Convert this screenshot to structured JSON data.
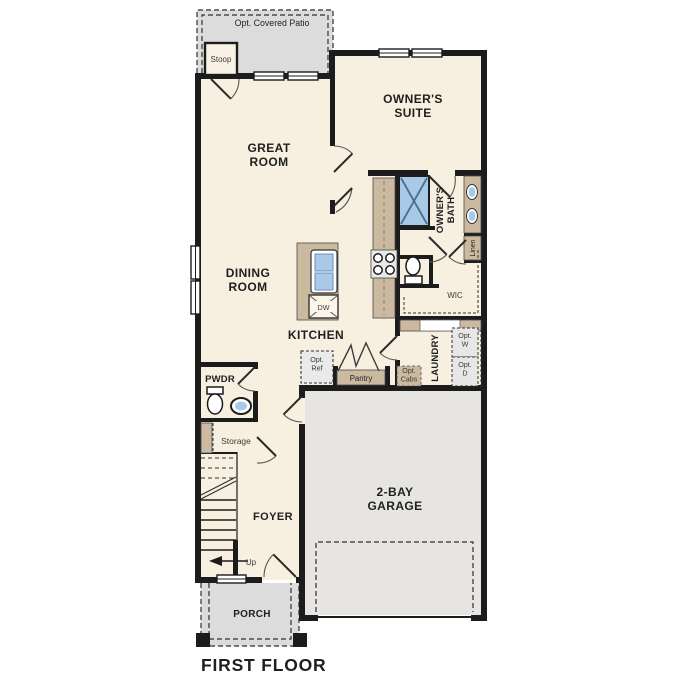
{
  "caption": "FIRST FLOOR",
  "colors": {
    "wall": "#1c1c1c",
    "room_fill": "#f7efdf",
    "exterior_concrete": "#dcdcdc",
    "garage_floor": "#e6e5e2",
    "cabinet_tan": "#cbbaa0",
    "fixture_blue": "#a9c9e8",
    "appliance_gray": "#e7e7e7",
    "label_text": "#1f1f1f"
  },
  "labels": {
    "patio": "Opt. Covered Patio",
    "stoop": "Stoop",
    "great_room": [
      "GREAT",
      "ROOM"
    ],
    "owners_suite": [
      "OWNER'S",
      "SUITE"
    ],
    "dining_room": [
      "DINING",
      "ROOM"
    ],
    "kitchen": "KITCHEN",
    "owners_bath": [
      "OWNER'S",
      "BATH"
    ],
    "linen": "Linen",
    "wic": "WIC",
    "laundry": "LAUNDRY",
    "pwdr": "PWDR",
    "storage": "Storage",
    "foyer": "FOYER",
    "garage": [
      "2-BAY",
      "GARAGE"
    ],
    "porch": "PORCH",
    "pantry": "Pantry",
    "dishwasher": "DW",
    "up": "Up",
    "opt_ref": [
      "Opt.",
      "Ref"
    ],
    "opt_cabs": [
      "Opt.",
      "Cabs"
    ],
    "opt_washer": [
      "Opt.",
      "W"
    ],
    "opt_dryer": [
      "Opt.",
      "D"
    ]
  }
}
